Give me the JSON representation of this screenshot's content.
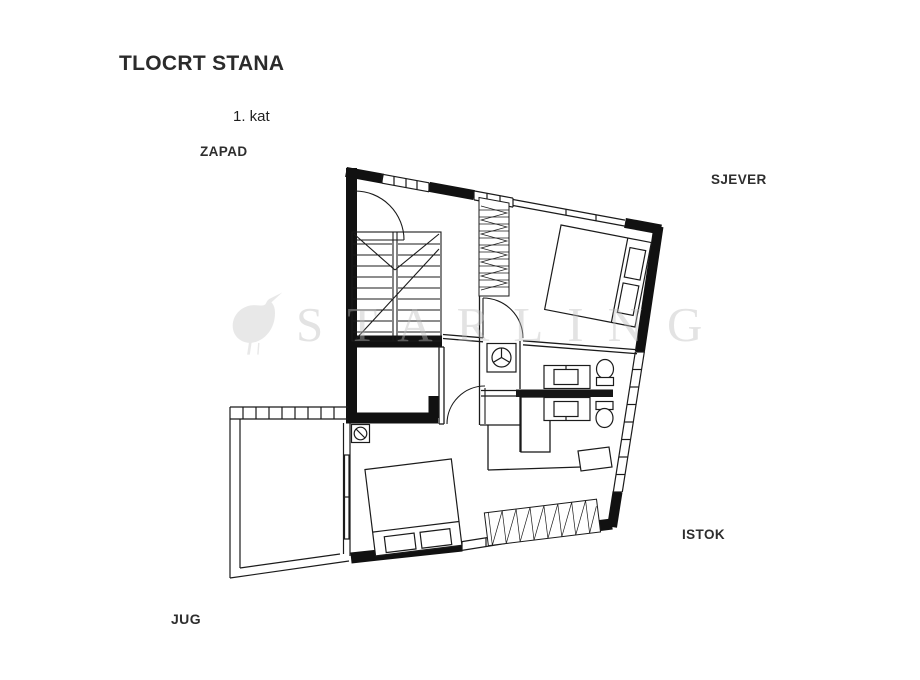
{
  "page": {
    "title": "TLOCRT STANA",
    "floor_label": "1. kat"
  },
  "compass": {
    "west": "ZAPAD",
    "north": "SJEVER",
    "east": "ISTOK",
    "south": "JUG"
  },
  "watermark": {
    "brand": "STARLING",
    "icon": "starling-bird-silhouette"
  },
  "colors": {
    "background": "#ffffff",
    "ink": "#1b1b1b",
    "wall_fill": "#111111",
    "label_text": "#2e2e2e",
    "watermark_gray": "#bdbdbd"
  },
  "floor_plan": {
    "type": "apartment-floor-plan",
    "floor": "1. kat",
    "visible_features": [
      "entry-door-with-swing-arc",
      "staircase",
      "hall-wardrobe-hatched",
      "bedroom-north-double-bed-two-pillows",
      "two-bathrooms-sink-toilet-shower",
      "washing-machine",
      "bedroom-south-double-bed-two-pillows",
      "bedroom-south-wardrobe-hatched",
      "terrace-west-with-railing",
      "sliding-glass-door",
      "perimeter-walls-with-window-bands"
    ]
  }
}
